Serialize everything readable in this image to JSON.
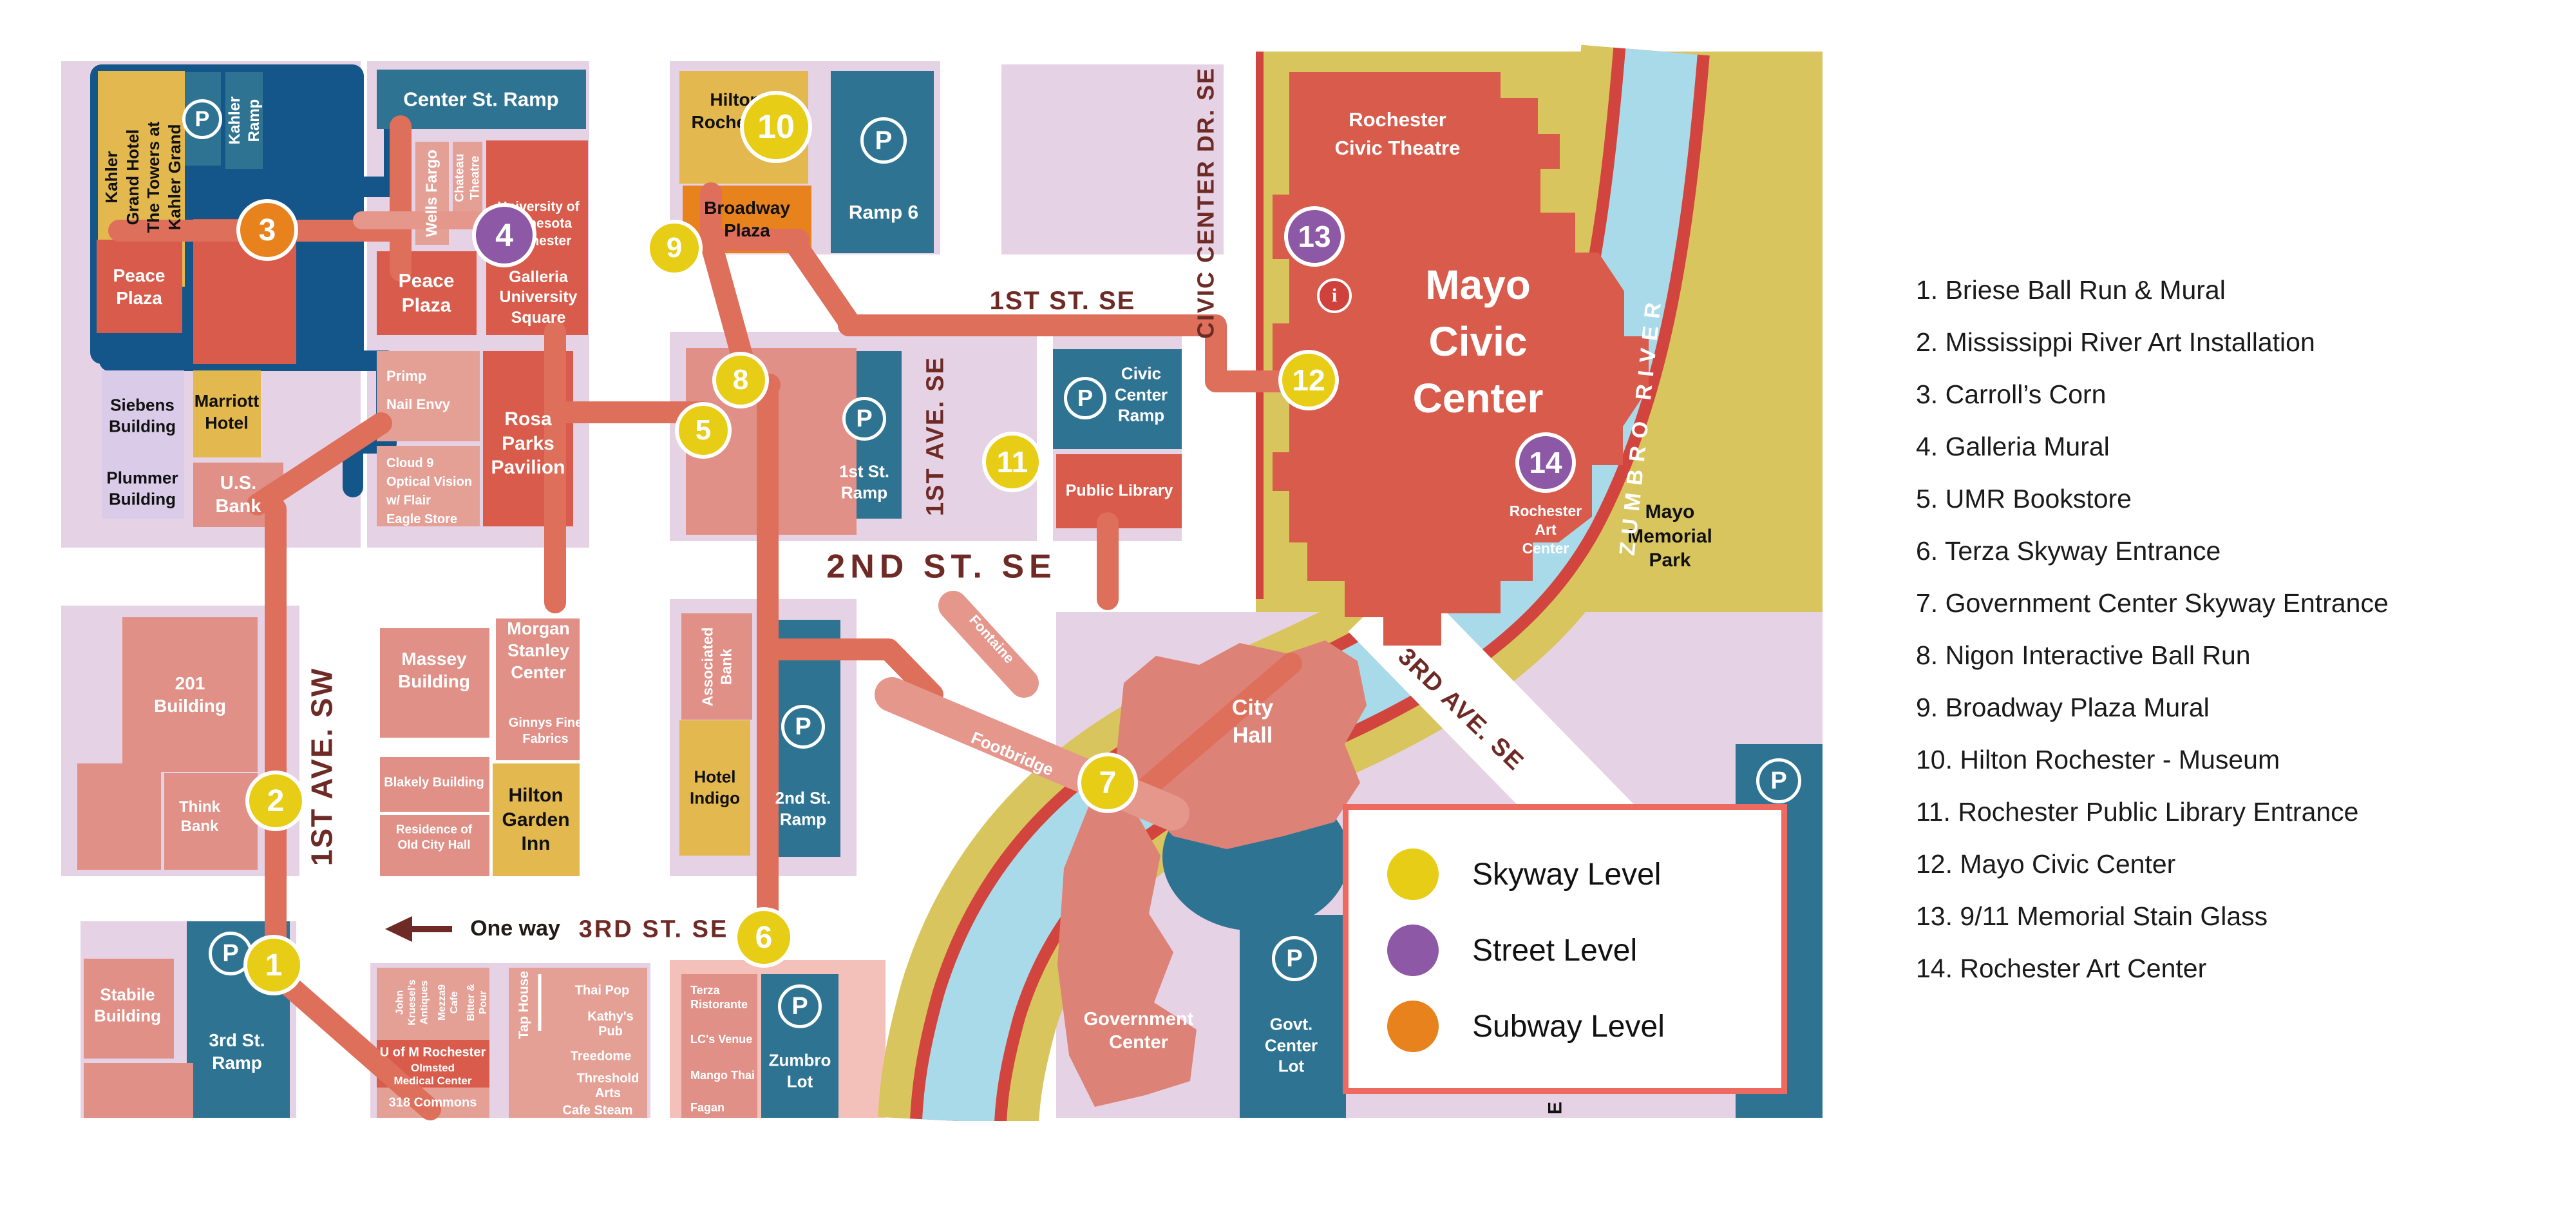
{
  "colors": {
    "skyway_level": "#e7cd15",
    "street_level": "#8d58a5",
    "subway_level": "#e8821d",
    "parking_teal": "#2e7492",
    "building_red": "#d85b4b",
    "route_salmon": "#dd6f5b",
    "river_blue": "#a9dae9",
    "street_text_maroon": "#6e2b26"
  },
  "legend": {
    "items": [
      {
        "label": "Skyway Level",
        "color": "#e7cd15"
      },
      {
        "label": "Street Level",
        "color": "#8d58a5"
      },
      {
        "label": "Subway Level",
        "color": "#e8821d"
      }
    ]
  },
  "poi_list": [
    "1. Briese Ball Run & Mural",
    "2. Mississippi River Art Installation",
    "3. Carroll’s Corn",
    "4. Galleria Mural",
    "5. UMR Bookstore",
    "6. Terza Skyway Entrance",
    "7. Government Center Skyway Entrance",
    "8. Nigon Interactive Ball Run",
    "9. Broadway Plaza Mural",
    "10. Hilton Rochester - Museum",
    "11. Rochester Public Library Entrance",
    "12. Mayo Civic Center",
    "13. 9/11 Memorial Stain Glass",
    "14. Rochester Art Center"
  ],
  "markers": {
    "m1": "1",
    "m2": "2",
    "m3": "3",
    "m4": "4",
    "m5": "5",
    "m6": "6",
    "m7": "7",
    "m8": "8",
    "m9": "9",
    "m10": "10",
    "m11": "11",
    "m12": "12",
    "m13": "13",
    "m14": "14",
    "info": "i"
  },
  "parking": {
    "p": "P"
  },
  "streets": {
    "ave1sw": "1ST AVE. SW",
    "st3": "3RD ST. SE",
    "one_way": "One way",
    "st2": "2ND ST. SE",
    "st1": "1ST ST. SE",
    "ave1se": "1ST AVE. SE",
    "civic_dr": "CIVIC CENTER DR. SE",
    "ave3": "3RD AVE. SE",
    "zumbro": "ZUMBRO RIVER",
    "footbridge": "Footbridge",
    "fragment_e": "E"
  },
  "b": {
    "kahler": "Kahler\nGrand Hotel\nThe Towers at\nKahler Grand",
    "kahler_ramp": "Kahler\nRamp",
    "center_ramp": "Center St. Ramp",
    "wells": "Wells Fargo",
    "chateau": "Chateau\nTheatre",
    "univ": "University of\nMinnesota\nRochester",
    "galleria": "Galleria\nUniversity\nSquare",
    "peace_w": "Peace\nPlaza",
    "peace_e": "Peace\nPlaza",
    "primp_group": "Primp\nNail Envy",
    "cloud_group": "Cloud 9\nOptical Vision\nw/ Flair\nEagle Store",
    "rosa": "Rosa\nParks\nPavilion",
    "siebens": "Siebens\nBuilding",
    "plummer": "Plummer\nBuilding",
    "marriott": "Marriott\nHotel",
    "usbank": "U.S.\nBank",
    "hilton_roch": "Hilton\nRochester",
    "broadway": "Broadway\nPlaza",
    "ramp6": "Ramp 6",
    "ramp1": "1st St.\nRamp",
    "civic_ramp": "Civic\nCenter\nRamp",
    "library": "Public Library",
    "assoc": "Associated\nBank",
    "indigo": "Hotel\nIndigo",
    "ramp2": "2nd St.\nRamp",
    "b201": "201\nBuilding",
    "think": "Think\nBank",
    "stabile": "Stabile\nBuilding",
    "ramp3": "3rd St.\nRamp",
    "massey": "Massey\nBuilding",
    "morgan": "Morgan\nStanley\nCenter",
    "ginnys": "Ginnys Fine\nFabrics",
    "blakely": "Blakely Building",
    "residence": "Residence of\nOld City Hall",
    "hilton_garden": "Hilton\nGarden\nInn",
    "john": "John\nKruesel's\nAntiques",
    "mezza": "Mezza9\nCafe",
    "bitter": "Bitter &\nPour",
    "uofm": "U of M Rochester",
    "olmsted": "Olmsted\nMedical Center",
    "commons": "318 Commons",
    "taphouse": "Tap House",
    "thai": "Thai Pop",
    "kathys": "Kathy's\nPub",
    "treedome": "Treedome",
    "threshold": "Threshold\nArts",
    "cafesteam": "Cafe Steam",
    "terza": "Terza\nRistorante",
    "lcs": "LC's Venue",
    "mango": "Mango Thai",
    "fagan": "Fagan",
    "zumbro_lot": "Zumbro\nLot",
    "cityhall": "City\nHall",
    "gov_center": "Government\nCenter",
    "govt_lot": "Govt.\nCenter\nLot",
    "mayo": "Mayo\nCivic\nCenter",
    "civic_theatre": "Rochester\nCivic Theatre",
    "art_center": "Rochester\nArt\nCenter",
    "mayo_park": "Mayo\nMemorial\nPark",
    "fontaine": "Fontaine"
  }
}
